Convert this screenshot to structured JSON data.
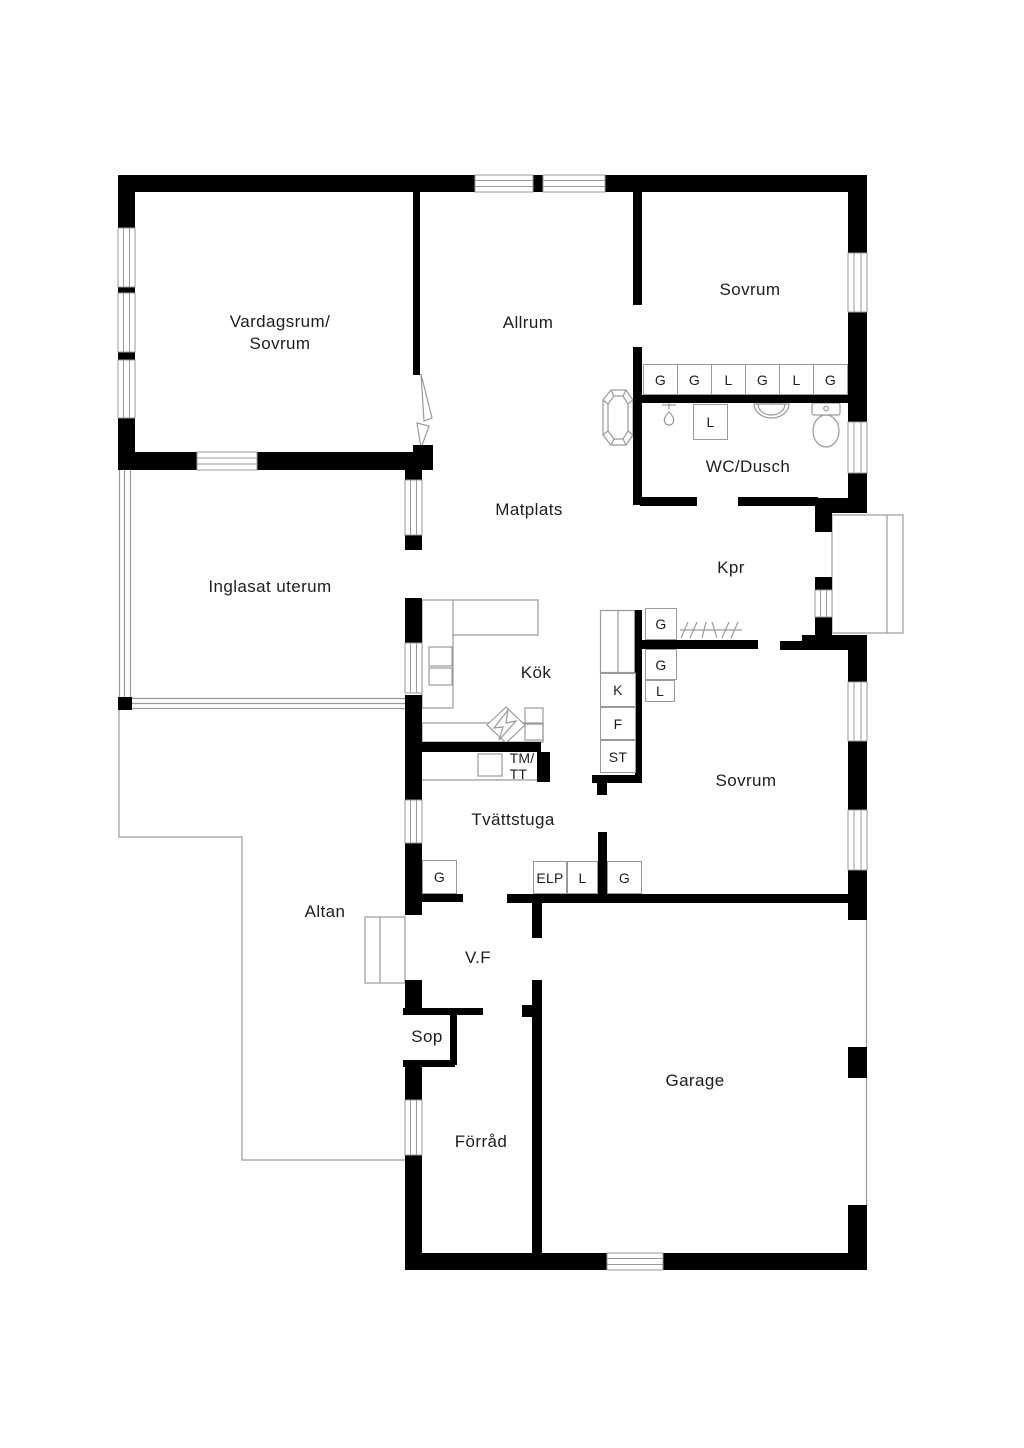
{
  "plan": {
    "type": "floor-plan",
    "background_color": "#ffffff",
    "wall_color": "#000000",
    "thin_line_color": "#9a9a9a",
    "text_color": "#1e1e1e"
  },
  "rooms": [
    {
      "id": "vardagsrum",
      "label": "Vardagsrum/\nSovrum"
    },
    {
      "id": "allrum",
      "label": "Allrum"
    },
    {
      "id": "sovrum-ne",
      "label": "Sovrum"
    },
    {
      "id": "wc-dusch",
      "label": "WC/Dusch"
    },
    {
      "id": "matplats",
      "label": "Matplats"
    },
    {
      "id": "inglasat-uterum",
      "label": "Inglasat uterum"
    },
    {
      "id": "kpr",
      "label": "Kpr"
    },
    {
      "id": "kok",
      "label": "Kök"
    },
    {
      "id": "sovrum-s",
      "label": "Sovrum"
    },
    {
      "id": "tvattstuga",
      "label": "Tvättstuga"
    },
    {
      "id": "altan",
      "label": "Altan"
    },
    {
      "id": "vf",
      "label": "V.F"
    },
    {
      "id": "sop",
      "label": "Sop"
    },
    {
      "id": "garage",
      "label": "Garage"
    },
    {
      "id": "forrad",
      "label": "Förråd"
    }
  ],
  "closets": [
    {
      "id": "wardrobe-1",
      "label": "G"
    },
    {
      "id": "wardrobe-2",
      "label": "G"
    },
    {
      "id": "wardrobe-3",
      "label": "L"
    },
    {
      "id": "wardrobe-4",
      "label": "G"
    },
    {
      "id": "wardrobe-5",
      "label": "L"
    },
    {
      "id": "wardrobe-6",
      "label": "G"
    },
    {
      "id": "wc-linen",
      "label": "L"
    },
    {
      "id": "kpr-wardrobe",
      "label": "G"
    },
    {
      "id": "sovrum-wardrobe",
      "label": "G"
    },
    {
      "id": "sovrum-linen",
      "label": "L"
    },
    {
      "id": "fridge",
      "label": "K"
    },
    {
      "id": "freezer",
      "label": "F"
    },
    {
      "id": "cleaning-closet",
      "label": "ST"
    },
    {
      "id": "laundry-wardrobe",
      "label": "G"
    },
    {
      "id": "electrical-panel",
      "label": "ELP"
    },
    {
      "id": "hall-linen",
      "label": "L"
    },
    {
      "id": "hall-wardrobe",
      "label": "G"
    }
  ],
  "appliances": [
    {
      "id": "washer-dryer",
      "label": "TM/\nTT"
    }
  ]
}
